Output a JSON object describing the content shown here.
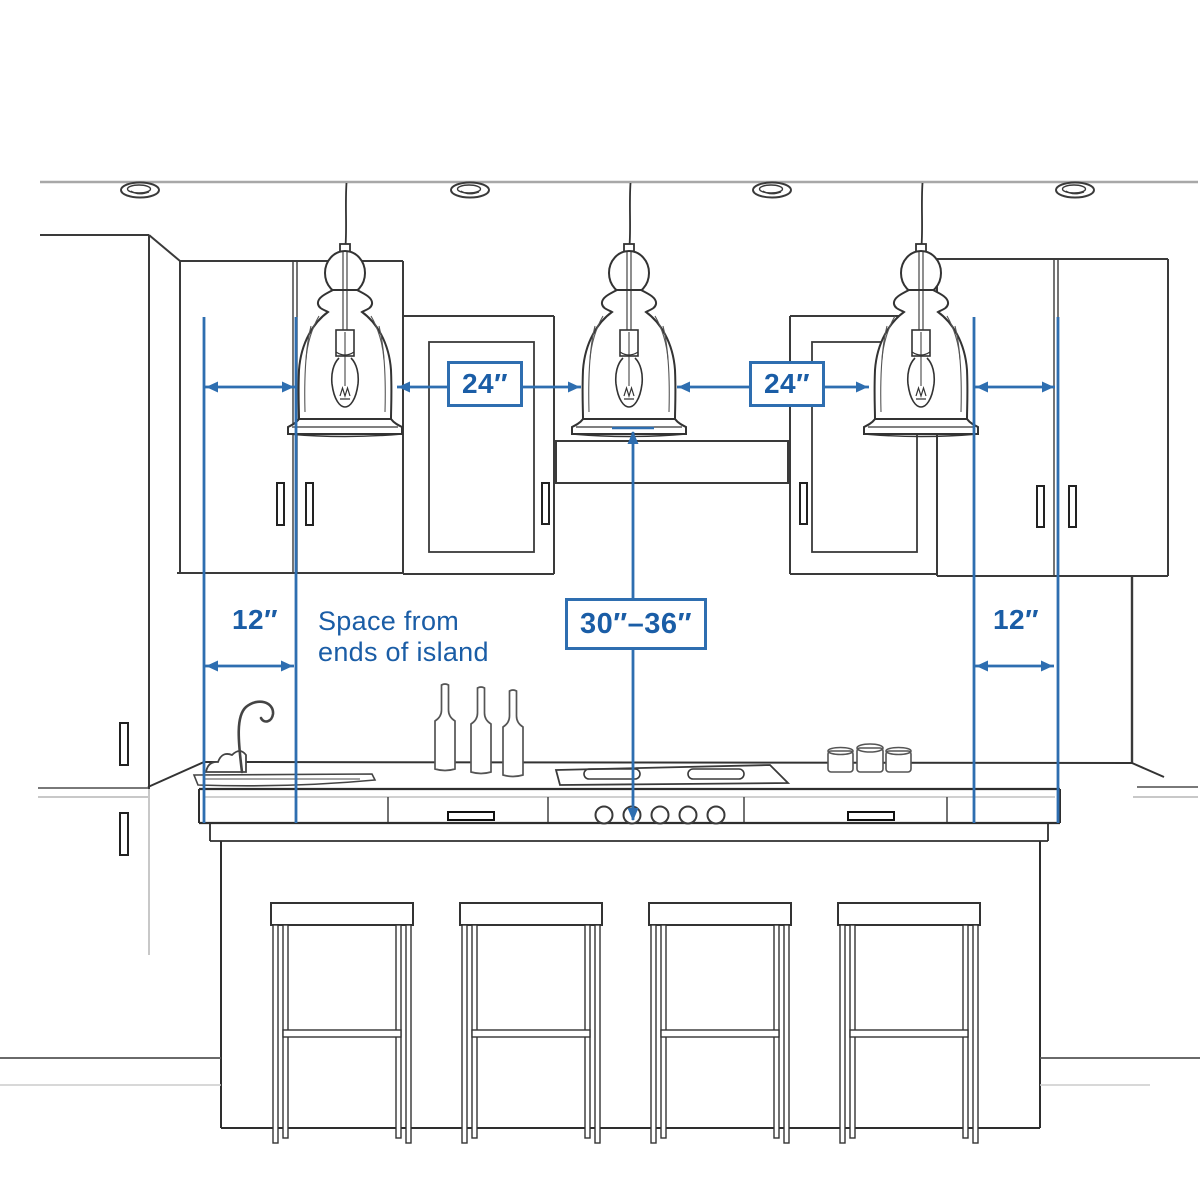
{
  "title": "Kitchen island pendant lighting spacing diagram",
  "colors": {
    "annotation_text": "#1A5DA6",
    "annotation_line": "#2E6EB0",
    "sketch_line": "#333333",
    "ceiling_line": "#A8A8A8",
    "background": "#FFFFFF"
  },
  "labels": {
    "pendant_gap_left": "24″",
    "pendant_gap_right": "24″",
    "island_end_left": "12″",
    "island_end_right": "12″",
    "counter_to_pendant": "30″–36″",
    "note_line1": "Space from",
    "note_line2": "ends of island"
  },
  "scene": {
    "elements": [
      "ceiling with four recessed lights",
      "three glass bell pendant lights with filament bulbs",
      "upper wall cabinets with door handles",
      "range hood between cabinets",
      "kitchen island with cooktop, knobs and drawers",
      "sink with gooseneck faucet",
      "three wine bottles on counter",
      "three jars beside cooktop",
      "four bar stools"
    ]
  }
}
